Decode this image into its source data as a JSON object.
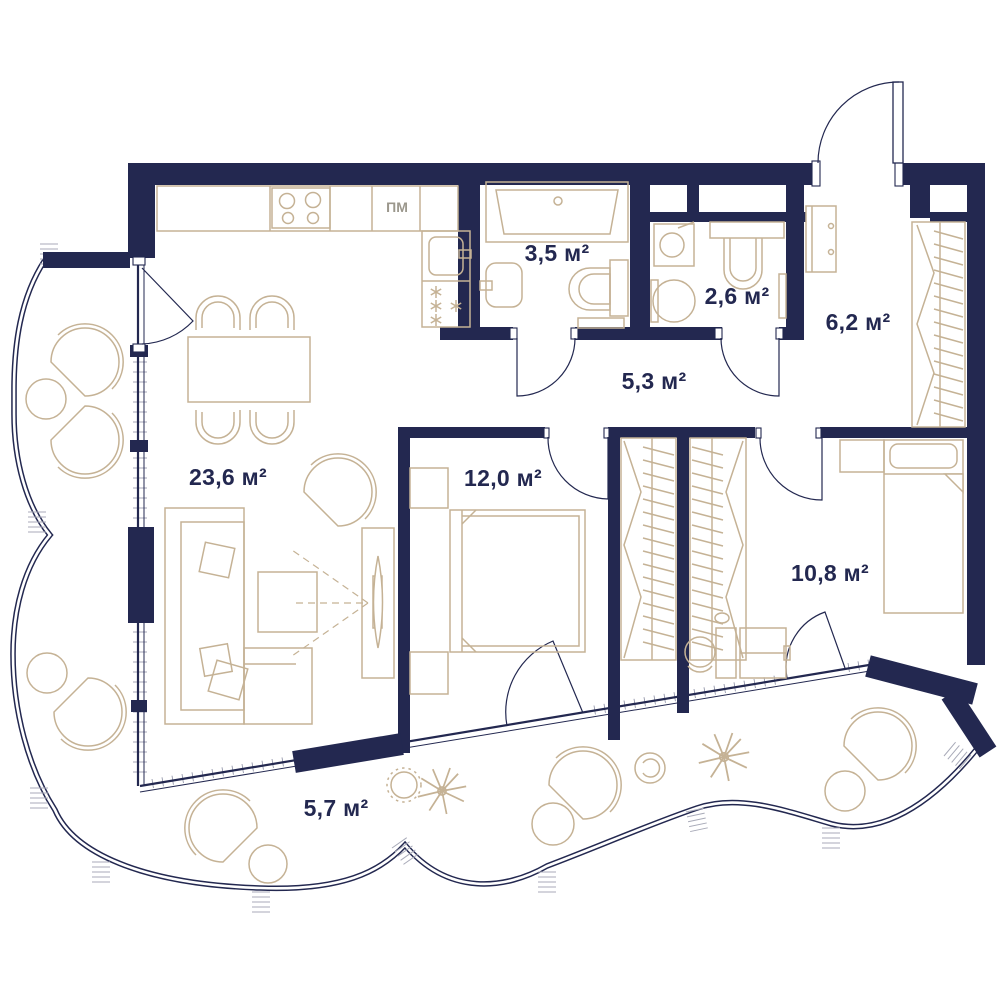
{
  "plan": {
    "type": "apartment-floor-plan",
    "units": "м²",
    "colors": {
      "walls": "#232850",
      "furniture": "#c5b295",
      "background": "#ffffff",
      "hatch": "#a8aab8"
    },
    "rooms": [
      {
        "id": "living-room-kitchen",
        "area": "23,6 м²"
      },
      {
        "id": "bathroom",
        "area": "3,5 м²"
      },
      {
        "id": "toilet",
        "area": "2,6 м²"
      },
      {
        "id": "entrance-hall",
        "area": "6,2 м²"
      },
      {
        "id": "corridor",
        "area": "5,3 м²"
      },
      {
        "id": "bedroom",
        "area": "12,0 м²"
      },
      {
        "id": "bedroom-2",
        "area": "10,8 м²"
      },
      {
        "id": "balcony",
        "area": "5,7 м²"
      }
    ],
    "labels": {
      "dishwasher": "ПМ"
    }
  }
}
